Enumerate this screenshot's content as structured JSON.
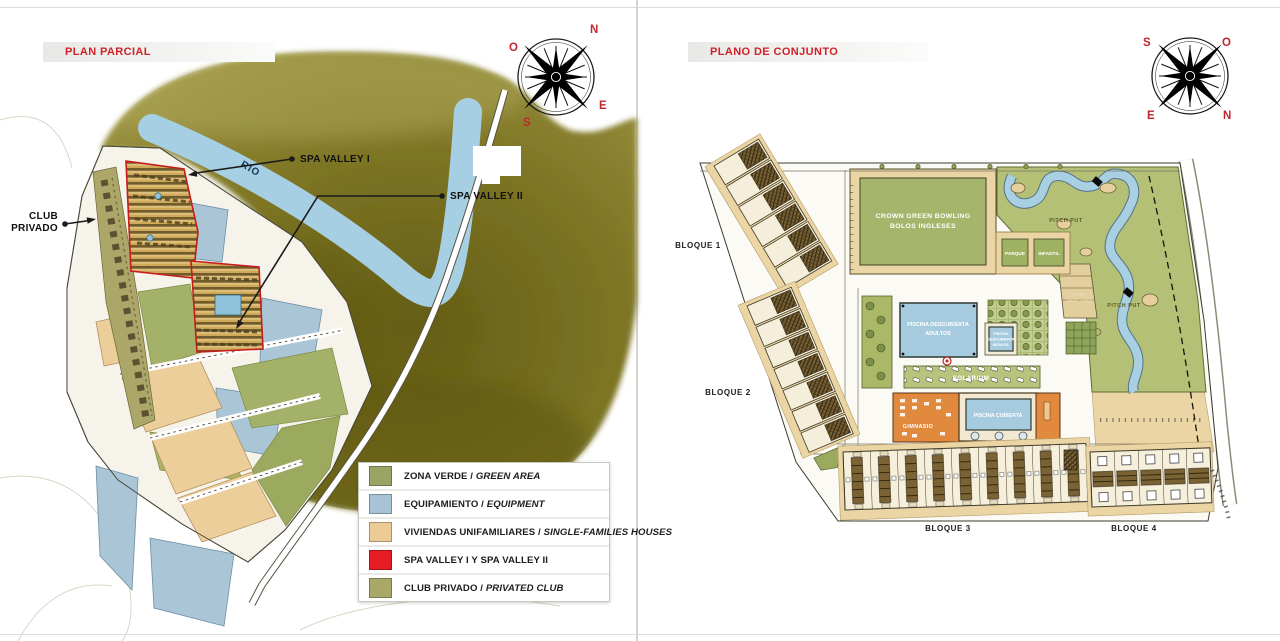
{
  "left_panel": {
    "title": "PLAN PARCIAL",
    "compass": {
      "n": "N",
      "o": "O",
      "s": "S",
      "e": "E"
    },
    "river_label": "RIO",
    "callouts": {
      "spa1": "SPA VALLEY I",
      "spa2": "SPA VALLEY II",
      "club_line1": "CLUB",
      "club_line2": "PRIVADO"
    },
    "legend": {
      "items": [
        {
          "main": "ZONA VERDE / ",
          "italic": "GREEN AREA",
          "color": "#98a567"
        },
        {
          "main": "EQUIPAMIENTO / ",
          "italic": "EQUIPMENT",
          "color": "#a7c3d6"
        },
        {
          "main": "VIVIENDAS UNIFAMILIARES / ",
          "italic": "SINGLE-FAMILIES HOUSES",
          "color": "#eccb97"
        },
        {
          "main": "SPA VALLEY I Y SPA VALLEY II",
          "italic": "",
          "color": "#e71d25"
        },
        {
          "main": "CLUB PRIVADO / ",
          "italic": "PRIVATED CLUB",
          "color": "#a9a868"
        }
      ]
    }
  },
  "right_panel": {
    "title": "PLANO DE CONJUNTO",
    "compass": {
      "s": "S",
      "o": "O",
      "e": "E",
      "n": "N"
    },
    "blocks": {
      "b1": "BLOQUE 1",
      "b2": "BLOQUE 2",
      "b3": "BLOQUE 3",
      "b4": "BLOQUE 4"
    },
    "facilities": {
      "bowling_line1": "CROWN GREEN BOWLING",
      "bowling_line2": "BOLOS INGLESES",
      "pool_adult_line1": "PISCINA DESCUBIERTA",
      "pool_adult_line2": "ADULTOS",
      "pool_child_line1": "PISCINA",
      "pool_child_line2": "DESCUBIERTA",
      "pool_child_line3": "INFANTIL",
      "indoor_pool": "PISCINA CUBIERTA",
      "gym": "GIMNASIO",
      "solarium": "SOLARIUM",
      "park_line1": "PARQUE",
      "park_line2": "INFANTIL",
      "pitch_put_a": "PITCH PUT",
      "pitch_put_b": "PITCH PUT",
      "rest_line1": "ZONA",
      "rest_line2": "DESCANSO"
    }
  }
}
